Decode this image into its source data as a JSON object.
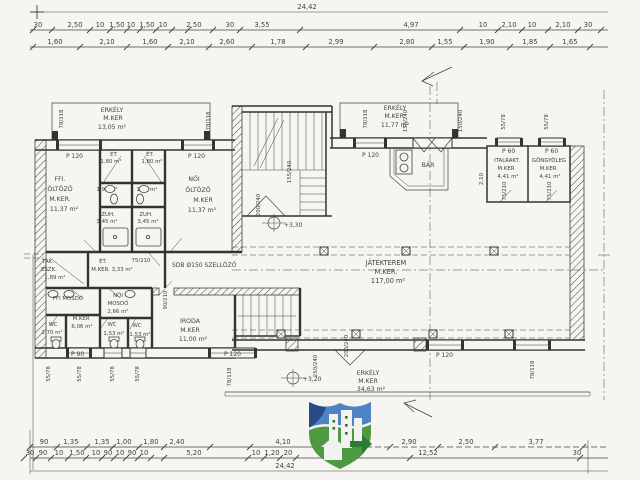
{
  "sheet": {
    "bg": "#f6f5f2",
    "ink": "#45423c"
  },
  "top_dims": {
    "overall": "24,42",
    "row1": [
      "30",
      "2,50",
      "10",
      "1,50",
      "10",
      "1,50",
      "10",
      "2,50",
      "30",
      "3,55",
      "4,97",
      "10",
      "2,10",
      "10",
      "2,10",
      "30"
    ],
    "row2": [
      "1,60",
      "2,10",
      "1,60",
      "2,10",
      "2,60",
      "1,78",
      "2,99",
      "2,80",
      "1,55",
      "1,90",
      "1,85",
      "1,65"
    ]
  },
  "bottom_dims": {
    "row1": [
      "90",
      "1,35",
      "1,35",
      "1,00",
      "1,80",
      "2,40",
      "4,10",
      "2,90",
      "2,50",
      "3,77"
    ],
    "row2": [
      "30",
      "90",
      "10",
      "1,50",
      "10",
      "90",
      "10",
      "90",
      "10",
      "5,20",
      "10",
      "1,20",
      "20",
      "30"
    ],
    "mid": "12,52",
    "overall": "24,42"
  },
  "rooms": {
    "erkely_tl": {
      "l1": "ERKÉLY",
      "l2": "M.KER",
      "l3": "13,05 m²"
    },
    "erkely_tr": {
      "l1": "ERKÉLY",
      "l2": "M.KER.",
      "l3": "11,77 m²"
    },
    "erkely_b": {
      "l1": "ERKÉLY",
      "l2": "M.KER",
      "l3": "34,63 m²"
    },
    "ffi_oltozo": {
      "l1": "FFI.",
      "l2": "ÖLTÖZŐ",
      "l3": "M.KER.",
      "l4": "11,37 m²"
    },
    "noi_oltozo": {
      "l1": "NŐI",
      "l2": "ÖLTÖZŐ",
      "l3": "M.KER",
      "l4": "11,37 m²"
    },
    "et_a": {
      "l1": "ÉT.",
      "l2": "1,80 m²"
    },
    "et_b": {
      "l1": "ÉT.",
      "l2": "1,80 m²"
    },
    "mosdo_a": "1,95 m²",
    "mosdo_b": "1,95 m²",
    "zuh_a": {
      "l1": "ZUH.",
      "l2": "3,45 m²"
    },
    "zuh_b": {
      "l1": "ZUH.",
      "l2": "3,45 m²"
    },
    "tak": {
      "l1": "TAK.",
      "l2": "ESZK.",
      "l3": "1,89 m²"
    },
    "et_c": {
      "l1": "ÉT.",
      "l2": "M.KER. 3,33 m²"
    },
    "szellozo": "SDB Ø150 SZELLŐZŐ",
    "ffi_mosdo": "FFI MOSDÓ",
    "noi_mosdo": {
      "l1": "NŐI",
      "l2": "MOSDÓ",
      "l3": "2,66 m²"
    },
    "wc_a": {
      "l1": "WC",
      "l2": "1,70 m²"
    },
    "kozl": {
      "l1": "M.KER",
      "l2": "6,06 m²"
    },
    "wc_b": {
      "l1": "WC",
      "l2": "1,53 m²"
    },
    "wc_c": {
      "l1": "WC",
      "l2": "1,53 m²"
    },
    "iroda": {
      "l1": "IRODA",
      "l2": "M.KER",
      "l3": "11,00 m²"
    },
    "jatekterem": {
      "l1": "JÁTÉKTEREM",
      "l2": "M.KER.",
      "l3": "117,00 m²"
    },
    "bar": "BÁR",
    "italrakt": {
      "l1": "ITALRAKT.",
      "l2": "M.KER",
      "l3": "4,41 m²"
    },
    "gongyoleg": {
      "l1": "GÖNGYÖLEG",
      "l2": "M.KER",
      "l3": "4,41 m²"
    }
  },
  "windows": {
    "p120": "P 120",
    "p90": "P 90",
    "p60": "P 60"
  },
  "marks": {
    "m78_118": "78/118",
    "m55_78": "55/78",
    "m150_240": "150/240",
    "m200_240": "200/240",
    "m155_240": "155/240",
    "m250_240": "250/240",
    "m90_210": "90/210",
    "m75_210": "75/210",
    "m210": "2,10"
  },
  "levels": {
    "hall": "+3,30",
    "balcony": "+3,20"
  }
}
